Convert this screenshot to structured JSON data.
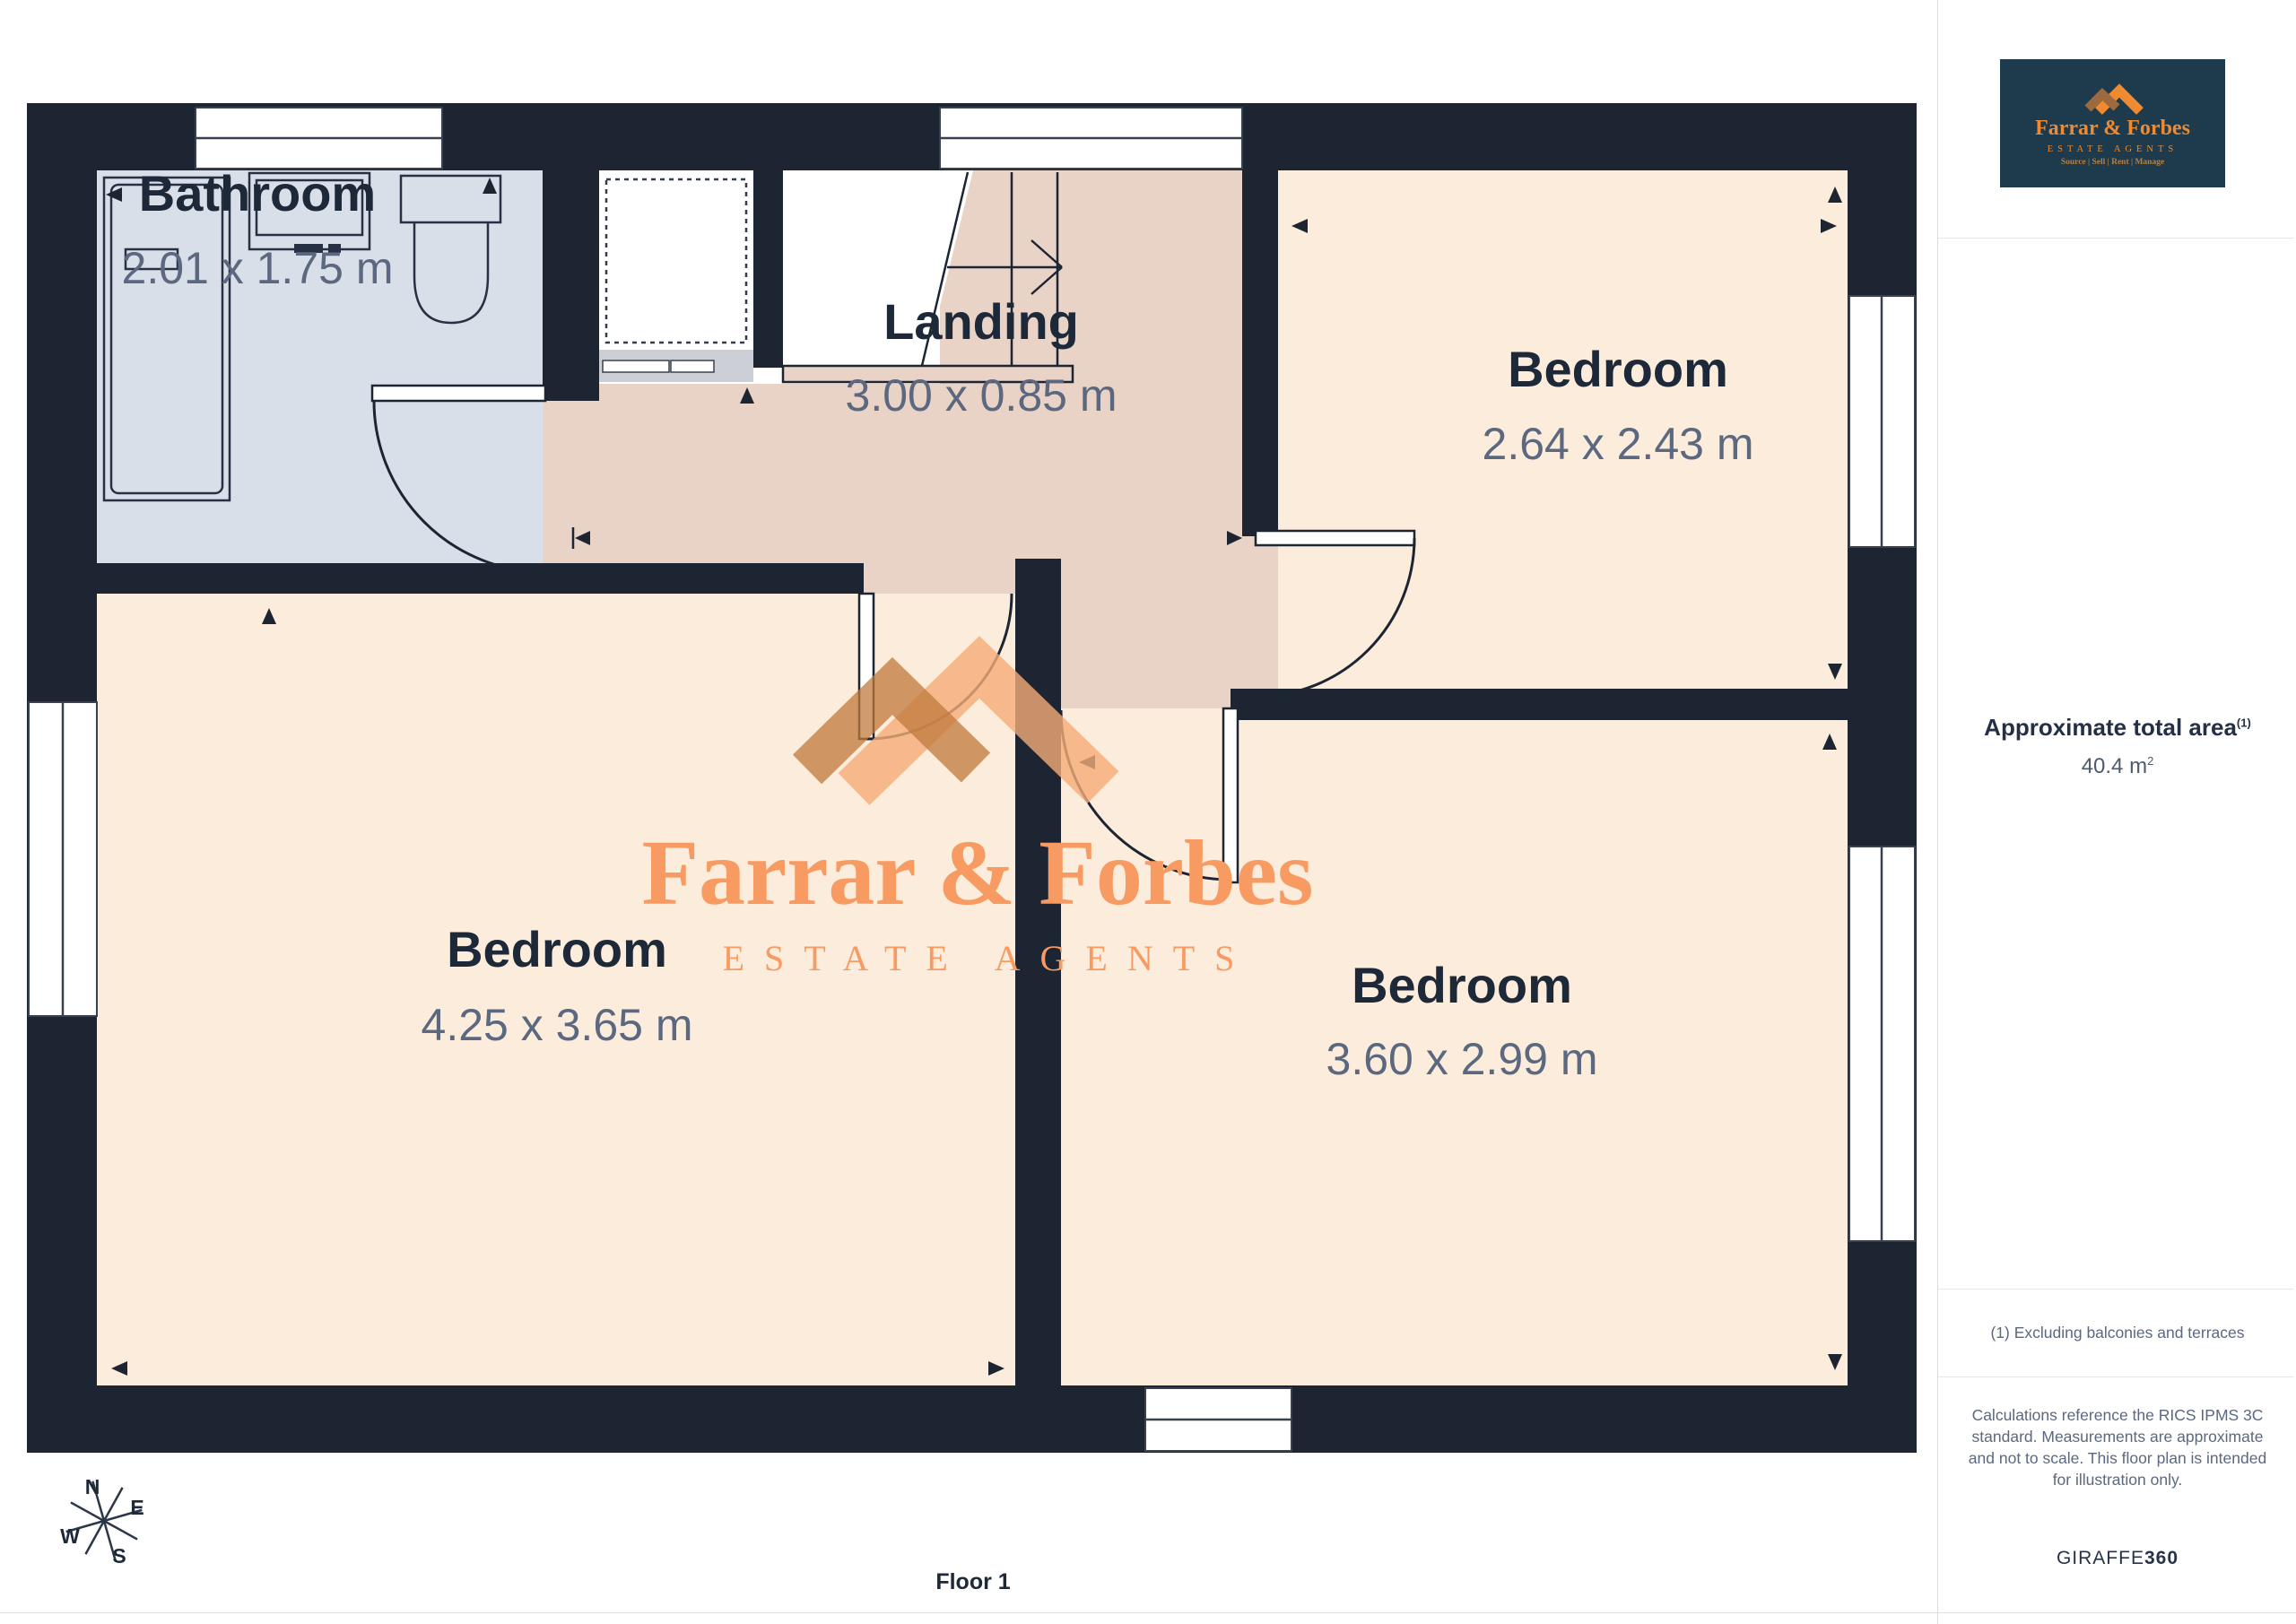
{
  "plan": {
    "rooms": [
      {
        "id": "bathroom",
        "label": "Bathroom",
        "dims": "2.01 x 1.75 m"
      },
      {
        "id": "landing",
        "label": "Landing",
        "dims": "3.00 x 0.85 m"
      },
      {
        "id": "bedroom-top-right",
        "label": "Bedroom",
        "dims": "2.64 x 2.43 m"
      },
      {
        "id": "bedroom-bottom-left",
        "label": "Bedroom",
        "dims": "4.25 x 3.65 m"
      },
      {
        "id": "bedroom-bottom-right",
        "label": "Bedroom",
        "dims": "3.60 x 2.99 m"
      }
    ],
    "floor_label": "Floor 1",
    "compass": {
      "n": "N",
      "e": "E",
      "s": "S",
      "w": "W"
    }
  },
  "watermark": {
    "title": "Farrar & Forbes",
    "subtitle": "ESTATE AGENTS"
  },
  "sidebar": {
    "logo": {
      "title": "Farrar & Forbes",
      "subtitle": "ESTATE AGENTS",
      "tagline": "Source | Sell | Rent | Manage"
    },
    "area_title": "Approximate total area",
    "area_sup": "(1)",
    "area_value": "40.4 m",
    "area_value_sup": "2",
    "footnote": "(1) Excluding balconies and terraces",
    "disclaimer": "Calculations reference the RICS IPMS 3C standard. Measurements are approximate and not to scale. This floor plan is intended for illustration only.",
    "brand": "GIRAFFE",
    "brand_suffix": "360"
  },
  "colors": {
    "wall": "#1d2532",
    "bath": "#d9dfe9",
    "bedroom": "#fcecdc",
    "landing": "#e9d2c6",
    "orange": "#f79b62",
    "logo-orange": "#ef8a30",
    "logo-bg": "#1e3a4d"
  }
}
